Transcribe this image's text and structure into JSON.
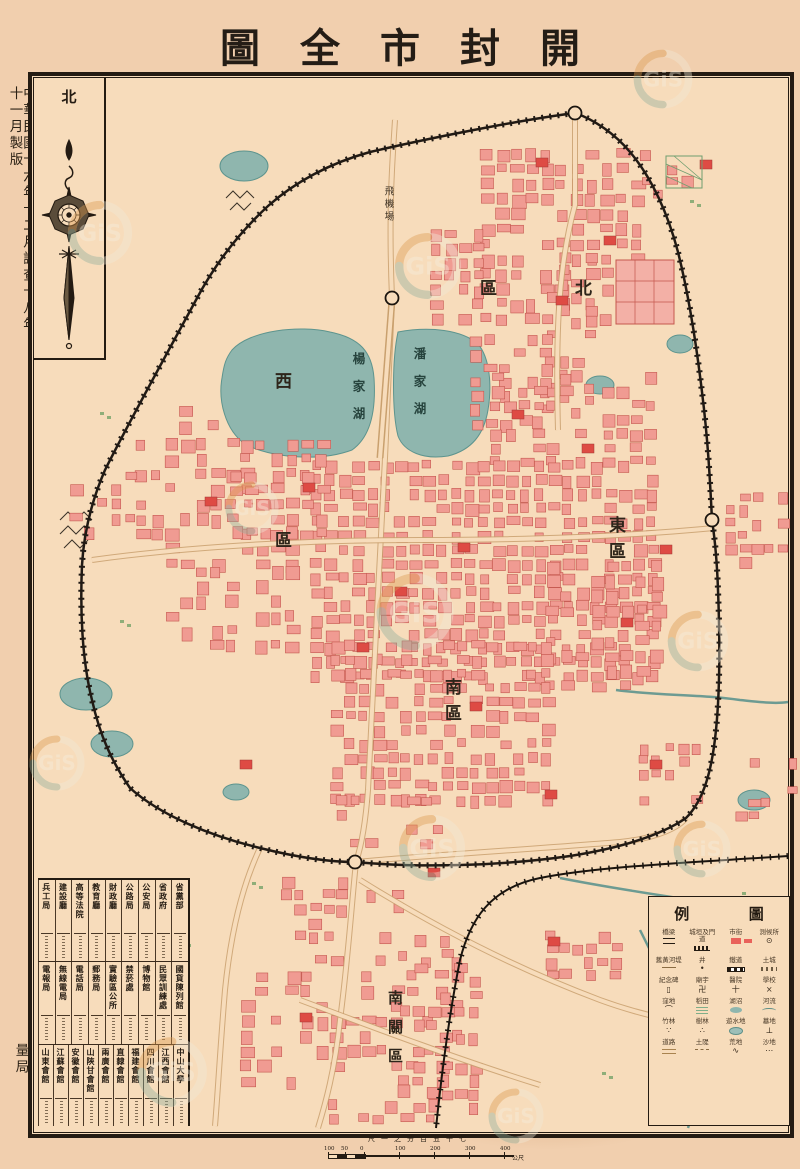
{
  "title": {
    "name": "開封市全圖",
    "display": "圖全市封開"
  },
  "edition_note": "中華民國十六年十二月調查十八年十一月製版",
  "publisher": "河南陸軍測量局",
  "compass": {
    "label": "北"
  },
  "districts": {
    "north": {
      "name": "北區",
      "display": "區北"
    },
    "west": {
      "name": "西區",
      "display": "西區"
    },
    "east": {
      "name": "東區",
      "display": "東區"
    },
    "south": {
      "name": "南區",
      "display": "南區"
    },
    "south_suburb": {
      "name": "南關區",
      "display": "南關區"
    }
  },
  "lakes": {
    "yang": {
      "name": "楊家湖"
    },
    "pan": {
      "name": "潘家湖"
    }
  },
  "airfield": {
    "name": "飛機場"
  },
  "legend": {
    "title": "圖例",
    "title_chars": [
      "例",
      "圖"
    ],
    "entries": [
      {
        "label": "測候所",
        "glyph": "⊙",
        "shape": ""
      },
      {
        "label": "市街",
        "glyph": "",
        "shape": "red-block"
      },
      {
        "label": "城垣及門道",
        "glyph": "",
        "shape": "wall"
      },
      {
        "label": "橋梁",
        "glyph": "",
        "shape": "bridge"
      },
      {
        "label": "土城",
        "glyph": "",
        "shape": "earth"
      },
      {
        "label": "鐵道",
        "glyph": "",
        "shape": "rail"
      },
      {
        "label": "井",
        "glyph": "•",
        "shape": ""
      },
      {
        "label": "舊黃河堤",
        "glyph": "",
        "shape": "dike"
      },
      {
        "label": "學校",
        "glyph": "×",
        "shape": ""
      },
      {
        "label": "醫院",
        "glyph": "十",
        "shape": ""
      },
      {
        "label": "廟宇",
        "glyph": "卍",
        "shape": ""
      },
      {
        "label": "紀念碑",
        "glyph": "▯",
        "shape": ""
      },
      {
        "label": "河流",
        "glyph": "",
        "shape": "river"
      },
      {
        "label": "湖沼",
        "glyph": "",
        "shape": "lake"
      },
      {
        "label": "稻田",
        "glyph": "",
        "shape": "paddy"
      },
      {
        "label": "窪地",
        "glyph": "⌒",
        "shape": ""
      },
      {
        "label": "墓地",
        "glyph": "⊥",
        "shape": ""
      },
      {
        "label": "遊水地",
        "glyph": "",
        "shape": "pond"
      },
      {
        "label": "樹林",
        "glyph": "∴",
        "shape": ""
      },
      {
        "label": "竹林",
        "glyph": "∵",
        "shape": ""
      },
      {
        "label": "沙地",
        "glyph": "⋯",
        "shape": ""
      },
      {
        "label": "荒地",
        "glyph": "∿",
        "shape": ""
      },
      {
        "label": "土隄",
        "glyph": "",
        "shape": "dike2"
      },
      {
        "label": "道路",
        "glyph": "",
        "shape": "road"
      }
    ]
  },
  "directory": {
    "sections": [
      {
        "name": "government-offices",
        "entries": [
          "省黨部",
          "省政府",
          "公安局",
          "公路局",
          "財政廳",
          "教育廳",
          "高等法院",
          "建設廳",
          "兵工局"
        ]
      },
      {
        "name": "public-institutions",
        "entries": [
          "國貨陳列館",
          "民眾訓練處",
          "博物館",
          "禁菸處",
          "實驗區公所",
          "郵務局",
          "電話局",
          "無線電局",
          "電報局"
        ]
      },
      {
        "name": "guild-halls-universities",
        "entries": [
          "中山大學",
          "江西會館",
          "四川會館",
          "福建會館",
          "直隸會館",
          "兩廣會館",
          "山陝甘會館",
          "安徽會館",
          "江蘇會館",
          "山東會館"
        ]
      }
    ]
  },
  "scale": {
    "ratio_label_display": "尺一之分百五千七",
    "ratio_meaning": "1:7500",
    "ticks": [
      "100",
      "50",
      "0",
      "100",
      "200",
      "300",
      "400"
    ],
    "unit": "公尺"
  },
  "watermark": {
    "text": "GiS"
  },
  "colors": {
    "paper": "#f7dcbb",
    "block_fill": "#f09b92",
    "block_stroke": "#c4574e",
    "block_dark": "#de4b44",
    "water": "#8fb6ae",
    "ink": "#241b12",
    "road": "#c9a06e"
  }
}
